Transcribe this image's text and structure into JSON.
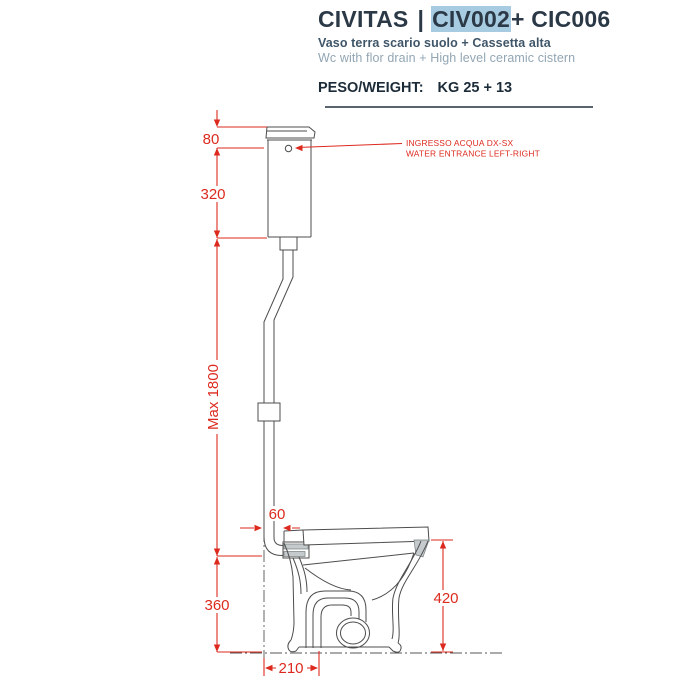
{
  "header": {
    "brand": "CIVITAS",
    "pipe": "|",
    "code": "CIV002",
    "code_suffix": "+ CIC006",
    "subtitle_it": "Vaso terra scario suolo + Cassetta alta",
    "subtitle_en": "Wc with flor drain + High level ceramic cistern",
    "weight_label": "PESO/WEIGHT:",
    "weight_value": "KG 25 + 13"
  },
  "drawing": {
    "dimensions": {
      "d80": "80",
      "d320": "320",
      "dmax": "Max 1800",
      "d360": "360",
      "d60": "60",
      "d420": "420",
      "d210": "210"
    },
    "annotation": {
      "line1": "INGRESSO ACQUA DX-SX",
      "line2": "WATER ENTRANCE LEFT-RIGHT"
    },
    "colors": {
      "dimension_red": "#dc2a1e",
      "line_gray": "#4d4d4d",
      "highlight_blue": "#a7cbe1",
      "divider_gray": "#5a646e"
    }
  }
}
